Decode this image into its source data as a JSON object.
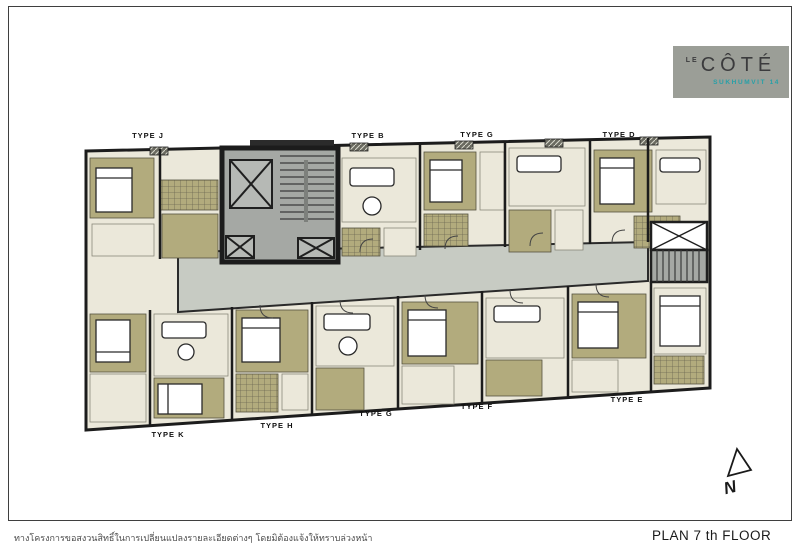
{
  "logo": {
    "le": "LE",
    "name": "CÔTÉ",
    "subtitle": "SUKHUMVIT 14"
  },
  "plan_title": "PLAN 7 th FLOOR",
  "disclaimer": "ทางโครงการขอสงวนสิทธิ์ในการเปลี่ยนแปลงรายละเอียดต่างๆ โดยมิต้องแจ้งให้ทราบล่วงหน้า",
  "compass": {
    "label": "N"
  },
  "unit_labels_top": [
    "TYPE J",
    "TYPE B",
    "TYPE G",
    "TYPE D"
  ],
  "unit_labels_bottom": [
    "TYPE K",
    "TYPE H",
    "TYPE G",
    "TYPE F",
    "TYPE E"
  ],
  "colors": {
    "logo_bg": "#9b9e97",
    "logo_accent": "#27a0a8",
    "wall": "#1c1c1c",
    "room_khaki": "#b2ab7d",
    "living_cream": "#ebe8da",
    "corridor": "#c7cbc3",
    "core": "#a5a8a4",
    "tile_line": "#6b6752"
  }
}
